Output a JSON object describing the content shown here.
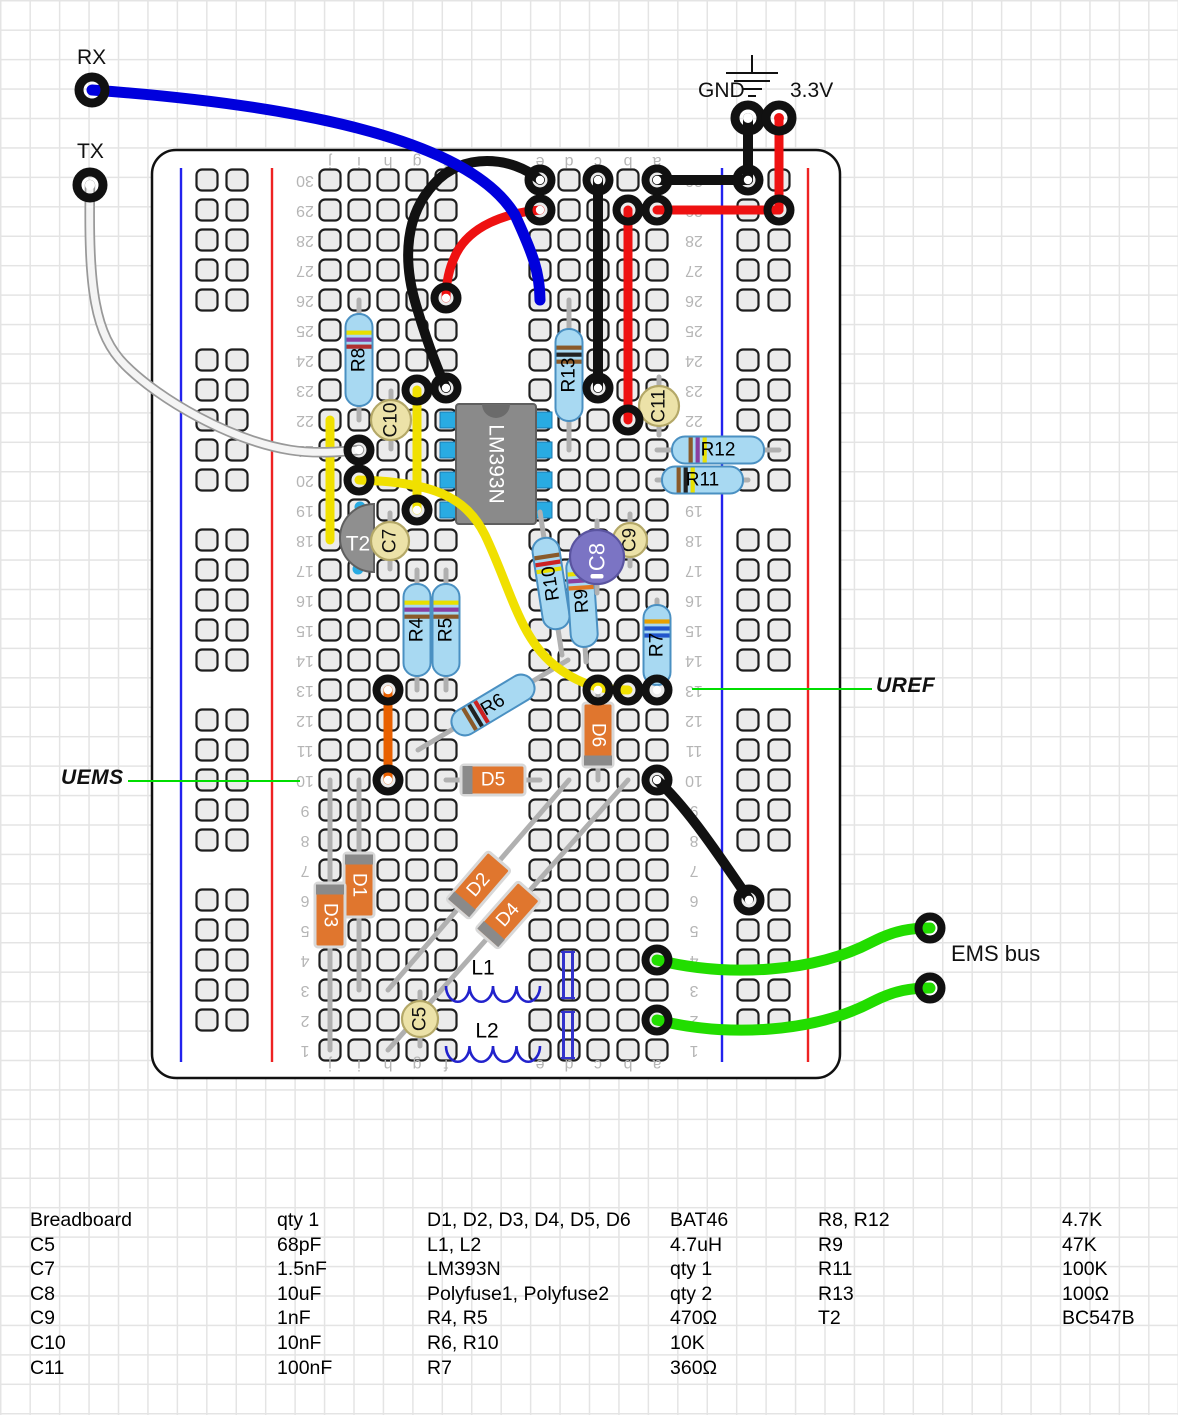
{
  "ports": {
    "rx": {
      "label": "RX"
    },
    "tx": {
      "label": "TX"
    },
    "gnd": {
      "label": "GND"
    },
    "v33": {
      "label": "3.3V"
    },
    "ems_bus": {
      "label": "EMS bus"
    },
    "uref": {
      "label": "UREF"
    },
    "uems": {
      "label": "UEMS"
    }
  },
  "board": {
    "x": 152,
    "y": 150,
    "w": 688,
    "h": 928,
    "column_letters": [
      "j",
      "i",
      "h",
      "g",
      "f",
      "e",
      "d",
      "c",
      "b",
      "a"
    ],
    "col_x": [
      330,
      359,
      388,
      417,
      446,
      540,
      569,
      598,
      628,
      657
    ],
    "row_count": 30,
    "row_y_bottom": 1050,
    "row_pitch": 30,
    "number_x_left": 305,
    "number_x_right": 694,
    "letters_y_top": 161,
    "letters_y_bottom": 1064,
    "rails": {
      "left": {
        "blue_x": 181,
        "red_x": 272,
        "hole_x": [
          207,
          237
        ]
      },
      "right": {
        "blue_x": 722,
        "red_x": 808,
        "hole_x": [
          748,
          779
        ]
      },
      "groups": [
        [
          30,
          26
        ],
        [
          24,
          20
        ],
        [
          18,
          14
        ],
        [
          12,
          8
        ],
        [
          6,
          2
        ]
      ],
      "line_y1": 168,
      "line_y2": 1062
    }
  },
  "ground_symbol": {
    "stem": [
      752,
      55,
      752,
      73
    ],
    "bars": [
      [
        726,
        778,
        73
      ],
      [
        734,
        770,
        81
      ],
      [
        742,
        762,
        89
      ],
      [
        748,
        756,
        96
      ]
    ]
  },
  "components": [
    {
      "type": "ic",
      "label": "LM393N",
      "x": 456,
      "y": 404,
      "w": 80,
      "h": 120,
      "pin_rows": [
        420,
        450,
        480,
        510
      ]
    },
    {
      "type": "transistor",
      "label": "T2",
      "cx": 374,
      "cy": 538,
      "r": 34
    },
    {
      "type": "resistor",
      "label": "R8",
      "x1": 359,
      "y1": 300,
      "x2": 359,
      "y2": 420,
      "bands": [
        "#e8e000",
        "#8a3fa0",
        "#b03030"
      ]
    },
    {
      "type": "resistor",
      "label": "R13",
      "x1": 569,
      "y1": 300,
      "x2": 569,
      "y2": 450,
      "bands": [
        "#8a5a2a",
        "#222222",
        "#8a5a2a"
      ]
    },
    {
      "type": "resistor",
      "label": "R12",
      "x1": 657,
      "y1": 450,
      "x2": 779,
      "y2": 450,
      "bands": [
        "#8a5a2a",
        "#8a3fa0",
        "#e8e000"
      ]
    },
    {
      "type": "resistor",
      "label": "R11",
      "x1": 657,
      "y1": 480,
      "x2": 748,
      "y2": 480,
      "bands": [
        "#8a5a2a",
        "#222222",
        "#e8e000"
      ]
    },
    {
      "type": "resistor",
      "label": "R4",
      "x1": 417,
      "y1": 570,
      "x2": 417,
      "y2": 690,
      "bands": [
        "#e8e000",
        "#8a3fa0",
        "#8a5a2a"
      ]
    },
    {
      "type": "resistor",
      "label": "R5",
      "x1": 446,
      "y1": 570,
      "x2": 446,
      "y2": 690,
      "bands": [
        "#e8e000",
        "#8a3fa0",
        "#8a5a2a"
      ]
    },
    {
      "type": "resistor",
      "label": "R6",
      "x1": 418,
      "y1": 750,
      "x2": 568,
      "y2": 660,
      "bands": [
        "#8a5a2a",
        "#222222",
        "#cc2222"
      ]
    },
    {
      "type": "resistor",
      "label": "R10",
      "x1": 540,
      "y1": 512,
      "x2": 562,
      "y2": 655,
      "bands": [
        "#8a5a2a",
        "#cc2222",
        "#e8e000"
      ]
    },
    {
      "type": "resistor",
      "label": "R9",
      "x1": 578,
      "y1": 540,
      "x2": 586,
      "y2": 662,
      "bands": [
        "#e8e000",
        "#8a3fa0",
        "#e07820"
      ]
    },
    {
      "type": "resistor",
      "label": "R7",
      "x1": 657,
      "y1": 600,
      "x2": 657,
      "y2": 690,
      "bands": [
        "#e8a000",
        "#2255cc",
        "#2255cc"
      ]
    },
    {
      "type": "diode",
      "label": "D1",
      "x1": 359,
      "y1": 780,
      "x2": 359,
      "y2": 990,
      "band": "start"
    },
    {
      "type": "diode",
      "label": "D3",
      "x1": 330,
      "y1": 780,
      "x2": 330,
      "y2": 1050,
      "band": "start"
    },
    {
      "type": "diode",
      "label": "D6",
      "x1": 598,
      "y1": 690,
      "x2": 598,
      "y2": 780,
      "band": "end"
    },
    {
      "type": "diode",
      "label": "D5",
      "x1": 446,
      "y1": 780,
      "x2": 540,
      "y2": 780,
      "band": "start"
    },
    {
      "type": "diode",
      "label": "D2",
      "x1": 569,
      "y1": 780,
      "x2": 388,
      "y2": 990,
      "band": "end"
    },
    {
      "type": "diode",
      "label": "D4",
      "x1": 628,
      "y1": 780,
      "x2": 388,
      "y2": 1050,
      "band": "end"
    },
    {
      "type": "cap",
      "label": "C10",
      "cx": 391,
      "cy": 420,
      "r": 20,
      "fill": "#ece2a8",
      "stroke": "#b4a868",
      "text": "#111111"
    },
    {
      "type": "cap",
      "label": "C7",
      "cx": 390,
      "cy": 541,
      "r": 19,
      "fill": "#ece2a8",
      "stroke": "#b4a868",
      "text": "#111111"
    },
    {
      "type": "cap",
      "label": "C11",
      "cx": 659,
      "cy": 406,
      "r": 20,
      "fill": "#ece2a8",
      "stroke": "#b4a868",
      "text": "#111111"
    },
    {
      "type": "cap",
      "label": "C9",
      "cx": 630,
      "cy": 540,
      "r": 17,
      "fill": "#ece2a8",
      "stroke": "#b4a868",
      "text": "#111111"
    },
    {
      "type": "cap",
      "label": "C8",
      "cx": 597,
      "cy": 557,
      "r": 27,
      "fill": "#7b74c4",
      "stroke": "#5a54a0",
      "text": "#ffffff",
      "minus": true
    },
    {
      "type": "cap",
      "label": "C5",
      "cx": 420,
      "cy": 1019,
      "r": 18,
      "fill": "#ece2a8",
      "stroke": "#b4a868",
      "text": "#111111"
    },
    {
      "type": "coil",
      "label": "L1",
      "x1": 446,
      "x2": 540,
      "y": 990,
      "lx": 483,
      "ly": 968
    },
    {
      "type": "coil",
      "label": "L2",
      "x1": 446,
      "x2": 540,
      "y": 1050,
      "lx": 487,
      "ly": 1031
    },
    {
      "type": "polyfuse",
      "label": "Polyfuse1",
      "x": 568,
      "y1": 952,
      "y2": 998
    },
    {
      "type": "polyfuse",
      "label": "Polyfuse2",
      "x": 568,
      "y1": 1012,
      "y2": 1058
    }
  ],
  "wires": [
    {
      "name": "gnd-drop",
      "color": "#111111",
      "w": 10,
      "path": "M 748 118 L 748 180"
    },
    {
      "name": "v33-drop",
      "color": "#ee1111",
      "w": 9,
      "path": "M 779 118 L 779 210"
    },
    {
      "name": "gnd-row30",
      "color": "#111111",
      "w": 10,
      "path": "M 657 180 L 748 180"
    },
    {
      "name": "v33-row29",
      "color": "#ee1111",
      "w": 9,
      "path": "M 657 210 L 779 210"
    },
    {
      "name": "black-column-c",
      "color": "#111111",
      "w": 10,
      "path": "M 598 180 L 598 388"
    },
    {
      "name": "red-column-b",
      "color": "#ee1111",
      "w": 9,
      "path": "M 628 210 L 628 420"
    },
    {
      "name": "black-curve",
      "color": "#111111",
      "w": 10,
      "path": "M 540 180 C 512 156 462 152 434 184 C 406 214 402 258 416 305 C 427 342 436 366 446 388"
    },
    {
      "name": "red-curve",
      "color": "#ee1111",
      "w": 9,
      "path": "M 540 210 C 505 213 470 226 456 254 C 449 268 446 282 446 298"
    },
    {
      "name": "orange-jumper",
      "color": "#e86000",
      "w": 9,
      "path": "M 388 690 L 388 780"
    },
    {
      "name": "yellow-short-1",
      "color": "#f0e000",
      "w": 9,
      "path": "M 330 420 L 330 540"
    },
    {
      "name": "yellow-short-2",
      "color": "#f0e000",
      "w": 9,
      "path": "M 417 390 L 417 510"
    },
    {
      "name": "yellow-long",
      "color": "#f0e000",
      "w": 9,
      "path": "M 359 480 C 430 482 465 495 485 535 C 512 592 520 640 558 668 C 585 688 608 690 628 690"
    },
    {
      "name": "black-diagonal",
      "color": "#111111",
      "w": 10,
      "path": "M 657 780 C 690 810 725 865 749 899"
    },
    {
      "name": "green-ems-1",
      "color": "#22dd00",
      "w": 11,
      "path": "M 657 960 C 730 978 815 972 872 942 C 895 930 912 928 930 928"
    },
    {
      "name": "green-ems-2",
      "color": "#22dd00",
      "w": 11,
      "path": "M 657 1020 C 730 1038 815 1032 872 1002 C 895 990 912 988 930 988"
    },
    {
      "name": "white-tx",
      "color": "#f4f4f4",
      "w": 7,
      "outline": "#999999",
      "ow": 10.5,
      "path": "M 90 185 C 88 290 95 335 125 365 C 160 400 230 440 290 450 C 315 454 340 452 359 450"
    },
    {
      "name": "blue-rx",
      "color": "#0000dd",
      "w": 11,
      "path": "M 92 90 C 300 105 470 140 515 215 C 532 252 540 272 540 300"
    }
  ],
  "pads": [
    {
      "x": 92,
      "y": 90,
      "c": "#0000dd",
      "big": true
    },
    {
      "x": 90,
      "y": 185,
      "c": "#ffffff",
      "big": true
    },
    {
      "x": 748,
      "y": 118,
      "c": "#ffffff",
      "big": true
    },
    {
      "x": 779,
      "y": 118,
      "c": "#ee1111",
      "big": true
    },
    {
      "x": 540,
      "y": 180,
      "c": "#ffffff"
    },
    {
      "x": 540,
      "y": 210,
      "c": "#ffffff"
    },
    {
      "x": 598,
      "y": 180,
      "c": "#ffffff"
    },
    {
      "x": 598,
      "y": 388,
      "c": "#ffffff"
    },
    {
      "x": 657,
      "y": 180,
      "c": "#ffffff"
    },
    {
      "x": 748,
      "y": 180,
      "c": "#ffffff"
    },
    {
      "x": 657,
      "y": 210,
      "c": "#ee1111"
    },
    {
      "x": 779,
      "y": 210,
      "c": "#ee1111"
    },
    {
      "x": 628,
      "y": 210,
      "c": "#ee1111"
    },
    {
      "x": 628,
      "y": 420,
      "c": "#ee1111"
    },
    {
      "x": 446,
      "y": 298,
      "c": "#ffffff"
    },
    {
      "x": 446,
      "y": 388,
      "c": "#ffffff"
    },
    {
      "x": 417,
      "y": 390,
      "c": "#f0e000"
    },
    {
      "x": 359,
      "y": 450,
      "c": "#ffffff"
    },
    {
      "x": 359,
      "y": 480,
      "c": "#f0e000"
    },
    {
      "x": 417,
      "y": 510,
      "c": "#ffffff"
    },
    {
      "x": 388,
      "y": 690,
      "c": "#ffffff"
    },
    {
      "x": 388,
      "y": 780,
      "c": "#ffffff"
    },
    {
      "x": 598,
      "y": 690,
      "c": "#ffffff"
    },
    {
      "x": 628,
      "y": 690,
      "c": "#f0e000"
    },
    {
      "x": 657,
      "y": 690,
      "c": "#ffffff"
    },
    {
      "x": 657,
      "y": 780,
      "c": "#ffffff"
    },
    {
      "x": 749,
      "y": 900,
      "c": "#ffffff"
    },
    {
      "x": 657,
      "y": 960,
      "c": "#22dd00"
    },
    {
      "x": 930,
      "y": 928,
      "c": "#22dd00"
    },
    {
      "x": 657,
      "y": 1020,
      "c": "#22dd00"
    },
    {
      "x": 930,
      "y": 988,
      "c": "#22dd00"
    }
  ],
  "annotations": [
    {
      "name": "uems-line",
      "x1": 128,
      "y1": 781,
      "x2": 300,
      "y2": 781,
      "color": "#00dd00"
    },
    {
      "name": "uref-line",
      "x1": 692,
      "y1": 689,
      "x2": 872,
      "y2": 689,
      "color": "#00dd00"
    }
  ],
  "legend": {
    "columns": [
      {
        "x": 30,
        "lines": [
          "Breadboard",
          "C5",
          "C7",
          "C8",
          "C9",
          "C10",
          "C11"
        ]
      },
      {
        "x": 277,
        "lines": [
          "qty 1",
          "68pF",
          "1.5nF",
          "10uF",
          "1nF",
          "10nF",
          "100nF"
        ]
      },
      {
        "x": 427,
        "lines": [
          "D1, D2, D3, D4, D5, D6",
          "L1, L2",
          "LM393N",
          "Polyfuse1, Polyfuse2",
          "R4, R5",
          "R6, R10",
          "R7"
        ]
      },
      {
        "x": 670,
        "lines": [
          "BAT46",
          "4.7uH",
          "qty 1",
          "qty 2",
          "470Ω",
          "10K",
          "360Ω"
        ]
      },
      {
        "x": 818,
        "lines": [
          "R8, R12",
          "R9",
          "R11",
          "R13",
          "T2"
        ]
      },
      {
        "x": 1062,
        "lines": [
          "4.7K",
          "47K",
          "100K",
          "100Ω",
          "BC547B"
        ]
      }
    ]
  },
  "colors": {
    "board_fill": "#ffffff",
    "board_stroke": "#111111",
    "hole_fill": "#ebebeb",
    "hole_stroke": "#1e1e1e",
    "rail_blue": "#2222ee",
    "rail_red": "#ee2222",
    "resistor_fill": "#a8d9f2",
    "resistor_stroke": "#4a90c2",
    "diode_fill": "#e0762e",
    "diode_stroke": "#d8d8d8",
    "diode_band": "#8a8a8a",
    "ic_fill": "#8a8a8a",
    "ic_stroke": "#5f5f5f",
    "pin_fill": "#29abe2",
    "lead": "#b0b0b0",
    "label_gray": "#b5b5b5",
    "coil": "#2222cc",
    "polyfuse": "#3333cc"
  }
}
